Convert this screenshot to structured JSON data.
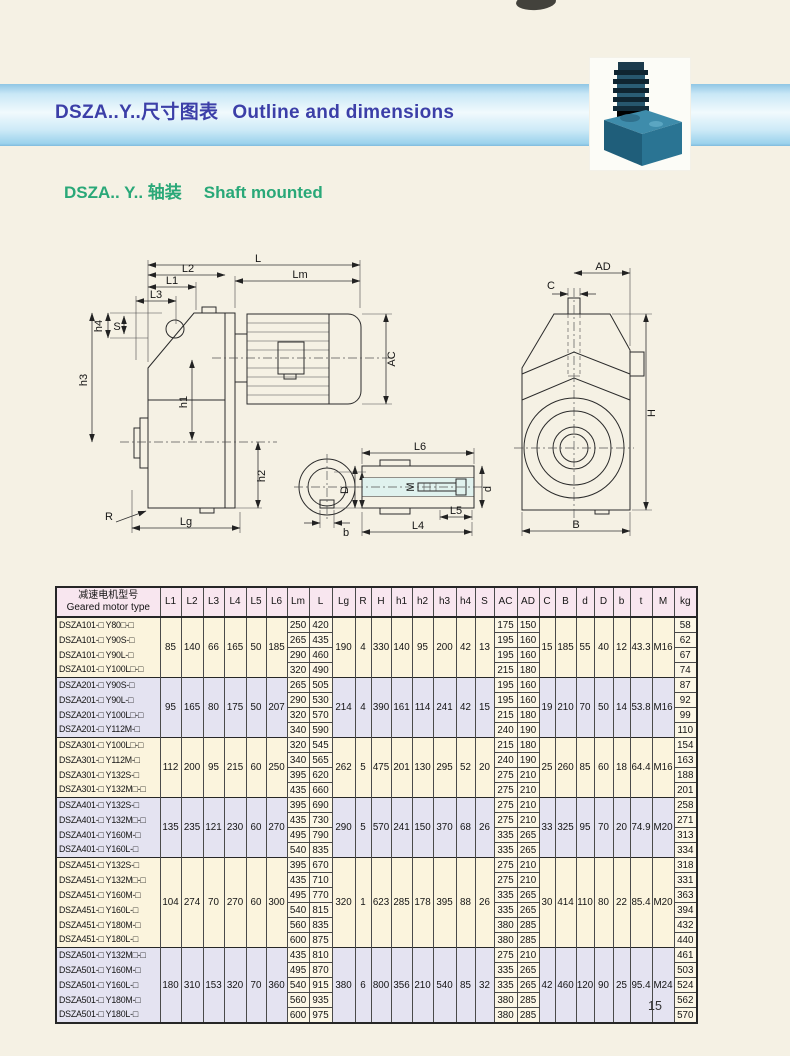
{
  "page": {
    "number": "15"
  },
  "header": {
    "title_zh": "DSZA..Y..尺寸图表",
    "title_en": "Outline and dimensions"
  },
  "subtitle": {
    "zh": "DSZA.. Y.. 轴装",
    "en": "Shaft mounted"
  },
  "colors": {
    "band_blue": "#9bd2ec",
    "title_blue": "#3c3fa8",
    "subtitle_green": "#29a878",
    "header_pink": "#f8e6ef",
    "group_cream": "#fbf4dd",
    "group_lavender": "#e4e3f1"
  },
  "drawings": {
    "labels": {
      "L": "L",
      "Lm": "Lm",
      "L1": "L1",
      "L2": "L2",
      "L3": "L3",
      "L4": "L4",
      "L5": "L5",
      "L6": "L6",
      "h1": "h1",
      "h2": "h2",
      "h3": "h3",
      "h4": "h4",
      "S": "S",
      "R": "R",
      "Lg": "Lg",
      "AC": "AC",
      "AD": "AD",
      "C": "C",
      "H": "H",
      "B": "B",
      "D": "D",
      "M": "M",
      "d": "d",
      "b": "b",
      "t": "t"
    }
  },
  "table": {
    "header": {
      "model_zh": "减速电机型号",
      "model_en": "Geared motor type",
      "columns": [
        "L1",
        "L2",
        "L3",
        "L4",
        "L5",
        "L6",
        "Lm",
        "L",
        "Lg",
        "R",
        "H",
        "h1",
        "h2",
        "h3",
        "h4",
        "S",
        "AC",
        "AD",
        "C",
        "B",
        "d",
        "D",
        "b",
        "t",
        "M",
        "kg"
      ]
    },
    "groups": [
      {
        "shared": {
          "L1": "85",
          "L2": "140",
          "L3": "66",
          "L4": "165",
          "L5": "50",
          "L6": "185",
          "Lg": "190",
          "R": "4",
          "H": "330",
          "h1": "140",
          "h2": "95",
          "h3": "200",
          "h4": "42",
          "S": "13",
          "C": "15",
          "B": "185",
          "d": "55",
          "D": "40",
          "b": "12",
          "t": "43.3",
          "M": "M16"
        },
        "rows": [
          {
            "model": "DSZA101-□ Y80□-□",
            "Lm": "250",
            "L": "420",
            "AC": "175",
            "AD": "150",
            "kg": "58"
          },
          {
            "model": "DSZA101-□ Y90S-□",
            "Lm": "265",
            "L": "435",
            "AC": "195",
            "AD": "160",
            "kg": "62"
          },
          {
            "model": "DSZA101-□ Y90L-□",
            "Lm": "290",
            "L": "460",
            "AC": "195",
            "AD": "160",
            "kg": "67"
          },
          {
            "model": "DSZA101-□ Y100L□-□",
            "Lm": "320",
            "L": "490",
            "AC": "215",
            "AD": "180",
            "kg": "74"
          }
        ]
      },
      {
        "shared": {
          "L1": "95",
          "L2": "165",
          "L3": "80",
          "L4": "175",
          "L5": "50",
          "L6": "207",
          "Lg": "214",
          "R": "4",
          "H": "390",
          "h1": "161",
          "h2": "114",
          "h3": "241",
          "h4": "42",
          "S": "15",
          "C": "19",
          "B": "210",
          "d": "70",
          "D": "50",
          "b": "14",
          "t": "53.8",
          "M": "M16"
        },
        "rows": [
          {
            "model": "DSZA201-□ Y90S-□",
            "Lm": "265",
            "L": "505",
            "AC": "195",
            "AD": "160",
            "kg": "87"
          },
          {
            "model": "DSZA201-□ Y90L-□",
            "Lm": "290",
            "L": "530",
            "AC": "195",
            "AD": "160",
            "kg": "92"
          },
          {
            "model": "DSZA201-□ Y100L□-□",
            "Lm": "320",
            "L": "570",
            "AC": "215",
            "AD": "180",
            "kg": "99"
          },
          {
            "model": "DSZA201-□ Y112M-□",
            "Lm": "340",
            "L": "590",
            "AC": "240",
            "AD": "190",
            "kg": "110"
          }
        ]
      },
      {
        "shared": {
          "L1": "112",
          "L2": "200",
          "L3": "95",
          "L4": "215",
          "L5": "60",
          "L6": "250",
          "Lg": "262",
          "R": "5",
          "H": "475",
          "h1": "201",
          "h2": "130",
          "h3": "295",
          "h4": "52",
          "S": "20",
          "C": "25",
          "B": "260",
          "d": "85",
          "D": "60",
          "b": "18",
          "t": "64.4",
          "M": "M16"
        },
        "rows": [
          {
            "model": "DSZA301-□ Y100L□-□",
            "Lm": "320",
            "L": "545",
            "AC": "215",
            "AD": "180",
            "kg": "154"
          },
          {
            "model": "DSZA301-□ Y112M-□",
            "Lm": "340",
            "L": "565",
            "AC": "240",
            "AD": "190",
            "kg": "163"
          },
          {
            "model": "DSZA301-□ Y132S-□",
            "Lm": "395",
            "L": "620",
            "AC": "275",
            "AD": "210",
            "kg": "188"
          },
          {
            "model": "DSZA301-□ Y132M□-□",
            "Lm": "435",
            "L": "660",
            "AC": "275",
            "AD": "210",
            "kg": "201"
          }
        ]
      },
      {
        "shared": {
          "L1": "135",
          "L2": "235",
          "L3": "121",
          "L4": "230",
          "L5": "60",
          "L6": "270",
          "Lg": "290",
          "R": "5",
          "H": "570",
          "h1": "241",
          "h2": "150",
          "h3": "370",
          "h4": "68",
          "S": "26",
          "C": "33",
          "B": "325",
          "d": "95",
          "D": "70",
          "b": "20",
          "t": "74.9",
          "M": "M20"
        },
        "rows": [
          {
            "model": "DSZA401-□ Y132S-□",
            "Lm": "395",
            "L": "690",
            "AC": "275",
            "AD": "210",
            "kg": "258"
          },
          {
            "model": "DSZA401-□ Y132M□-□",
            "Lm": "435",
            "L": "730",
            "AC": "275",
            "AD": "210",
            "kg": "271"
          },
          {
            "model": "DSZA401-□ Y160M-□",
            "Lm": "495",
            "L": "790",
            "AC": "335",
            "AD": "265",
            "kg": "313"
          },
          {
            "model": "DSZA401-□ Y160L-□",
            "Lm": "540",
            "L": "835",
            "AC": "335",
            "AD": "265",
            "kg": "334"
          }
        ]
      },
      {
        "shared": {
          "L1": "104",
          "L2": "274",
          "L3": "70",
          "L4": "270",
          "L5": "60",
          "L6": "300",
          "Lg": "320",
          "R": "1",
          "H": "623",
          "h1": "285",
          "h2": "178",
          "h3": "395",
          "h4": "88",
          "S": "26",
          "C": "30",
          "B": "414",
          "d": "110",
          "D": "80",
          "b": "22",
          "t": "85.4",
          "M": "M20"
        },
        "rows": [
          {
            "model": "DSZA451-□ Y132S-□",
            "Lm": "395",
            "L": "670",
            "AC": "275",
            "AD": "210",
            "kg": "318"
          },
          {
            "model": "DSZA451-□ Y132M□-□",
            "Lm": "435",
            "L": "710",
            "AC": "275",
            "AD": "210",
            "kg": "331"
          },
          {
            "model": "DSZA451-□ Y160M-□",
            "Lm": "495",
            "L": "770",
            "AC": "335",
            "AD": "265",
            "kg": "363"
          },
          {
            "model": "DSZA451-□ Y160L-□",
            "Lm": "540",
            "L": "815",
            "AC": "335",
            "AD": "265",
            "kg": "394"
          },
          {
            "model": "DSZA451-□ Y180M-□",
            "Lm": "560",
            "L": "835",
            "AC": "380",
            "AD": "285",
            "kg": "432"
          },
          {
            "model": "DSZA451-□ Y180L-□",
            "Lm": "600",
            "L": "875",
            "AC": "380",
            "AD": "285",
            "kg": "440"
          }
        ]
      },
      {
        "shared": {
          "L1": "180",
          "L2": "310",
          "L3": "153",
          "L4": "320",
          "L5": "70",
          "L6": "360",
          "Lg": "380",
          "R": "6",
          "H": "800",
          "h1": "356",
          "h2": "210",
          "h3": "540",
          "h4": "85",
          "S": "32",
          "C": "42",
          "B": "460",
          "d": "120",
          "D": "90",
          "b": "25",
          "t": "95.4",
          "M": "M24"
        },
        "rows": [
          {
            "model": "DSZA501-□ Y132M□-□",
            "Lm": "435",
            "L": "810",
            "AC": "275",
            "AD": "210",
            "kg": "461"
          },
          {
            "model": "DSZA501-□ Y160M-□",
            "Lm": "495",
            "L": "870",
            "AC": "335",
            "AD": "265",
            "kg": "503"
          },
          {
            "model": "DSZA501-□ Y160L-□",
            "Lm": "540",
            "L": "915",
            "AC": "335",
            "AD": "265",
            "kg": "524"
          },
          {
            "model": "DSZA501-□ Y180M-□",
            "Lm": "560",
            "L": "935",
            "AC": "380",
            "AD": "285",
            "kg": "562"
          },
          {
            "model": "DSZA501-□ Y180L-□",
            "Lm": "600",
            "L": "975",
            "AC": "380",
            "AD": "285",
            "kg": "570"
          }
        ]
      }
    ]
  }
}
